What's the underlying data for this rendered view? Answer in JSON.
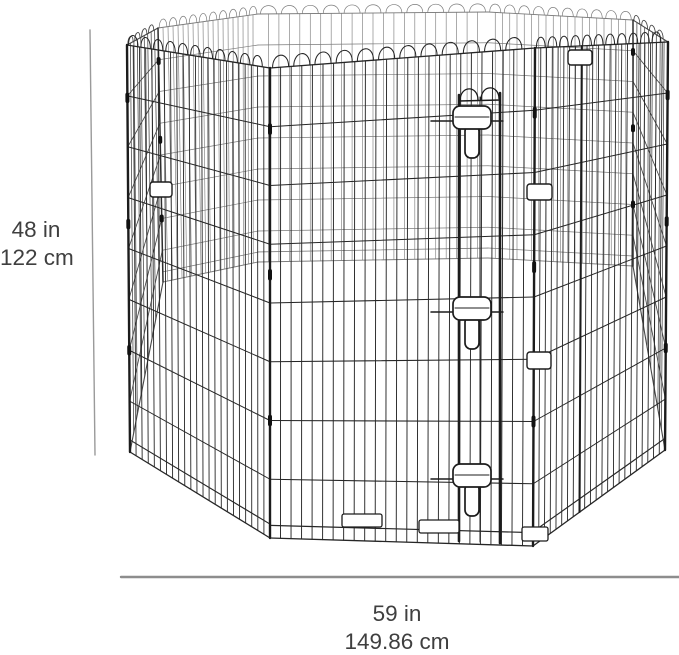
{
  "product_diagram": {
    "height_label": {
      "inches": "48 in",
      "centimeters": "122 cm"
    },
    "width_label": {
      "inches": "59 in",
      "centimeters": "149.86 cm"
    }
  },
  "style": {
    "ink": "#262626",
    "far_side": "#7b7b7b",
    "side_panel": "#474747",
    "post": "#1c1c1c",
    "dimension_line": "#8d8d8d",
    "label_text": "#3f3f3f",
    "background": "#ffffff"
  }
}
